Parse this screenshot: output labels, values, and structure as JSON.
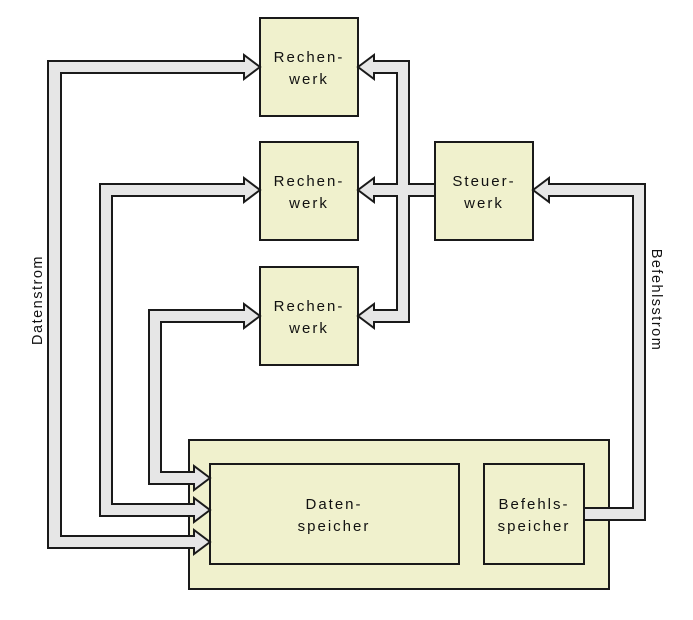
{
  "diagram": {
    "kind": "SIMD architecture block diagram",
    "colors": {
      "box_fill": "#f0f1cd",
      "arrow_fill": "#e6e6e6",
      "outline": "#1a1a1a",
      "background": "#ffffff"
    },
    "nodes": {
      "rechenwerk1": {
        "line1": "Rechen-",
        "line2": "werk"
      },
      "rechenwerk2": {
        "line1": "Rechen-",
        "line2": "werk"
      },
      "rechenwerk3": {
        "line1": "Rechen-",
        "line2": "werk"
      },
      "steuerwerk": {
        "line1": "Steuer-",
        "line2": "werk"
      },
      "datenspeicher": {
        "line1": "Daten-",
        "line2": "speicher"
      },
      "befehlsspeicher": {
        "line1": "Befehls-",
        "line2": "speicher"
      }
    },
    "stream_labels": {
      "left": "Datenstrom",
      "right": "Befehlsstrom"
    }
  }
}
